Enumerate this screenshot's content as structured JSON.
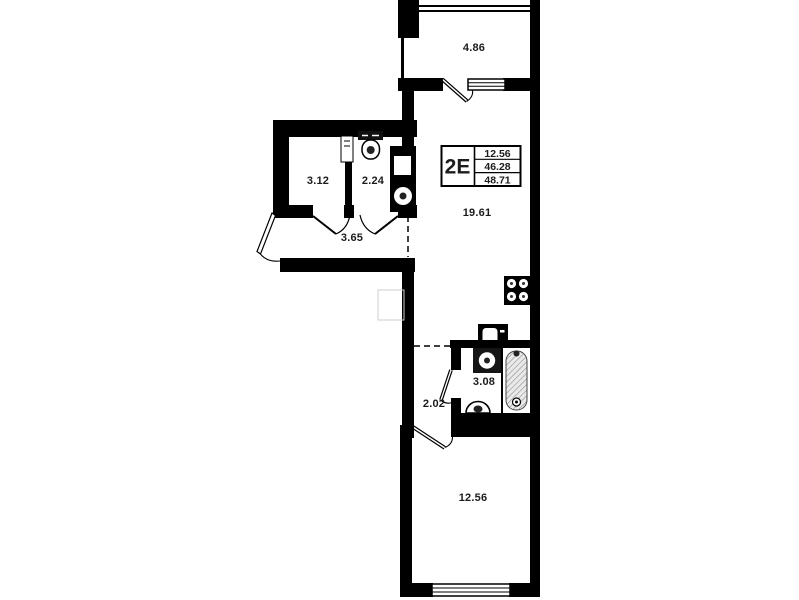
{
  "plan": {
    "wall_color": "#000000",
    "background": "#ffffff"
  },
  "unit_card": {
    "code": "2E",
    "values": [
      "12.56",
      "46.28",
      "48.71"
    ]
  },
  "rooms": {
    "balcony": "4.86",
    "room_a": "3.12",
    "room_b": "2.24",
    "hallway": "3.65",
    "kitchen_living": "19.61",
    "bathroom": "3.08",
    "corridor": "2.02",
    "bedroom": "12.56"
  }
}
